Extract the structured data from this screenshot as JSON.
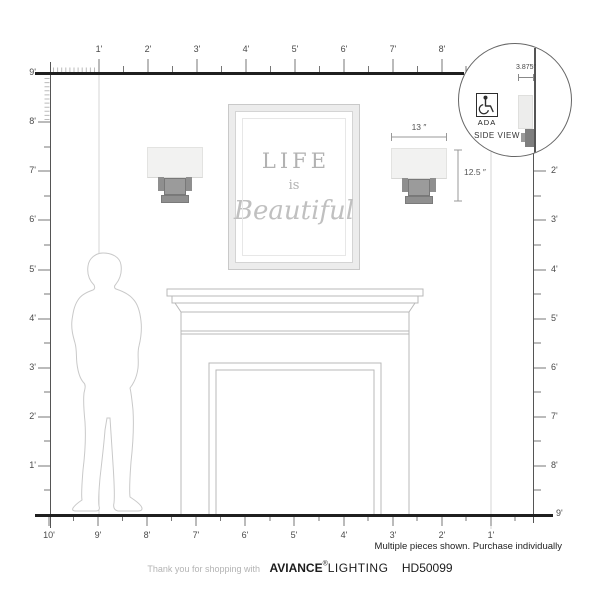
{
  "rulers": {
    "top": {
      "labels": [
        "1'",
        "2'",
        "3'",
        "4'",
        "5'",
        "6'",
        "7'",
        "8'"
      ],
      "corner_label": "9'"
    },
    "left": {
      "labels": [
        "8'",
        "7'",
        "6'",
        "5'",
        "4'",
        "3'",
        "2'",
        "1'"
      ]
    },
    "right": {
      "labels": [
        "2'",
        "3'",
        "4'",
        "5'",
        "6'",
        "7'",
        "8'"
      ],
      "corner_label": "9'"
    },
    "bottom": {
      "labels": [
        "10'",
        "9'",
        "8'",
        "7'",
        "6'",
        "5'",
        "4'",
        "3'",
        "2'",
        "1'"
      ]
    }
  },
  "artwork": {
    "line1": "LIFE",
    "line2": "is",
    "line3": "Beautiful"
  },
  "annotations": {
    "width": "13 ″",
    "height": "12.5 ″",
    "depth": "3.875″"
  },
  "inset": {
    "ada_label": "ADA",
    "side_view_label": "SIDE VIEW"
  },
  "notice": "Multiple pieces shown. Purchase individually",
  "footer": {
    "prefix": "Thank you for shopping with",
    "brand": "AVIANCE",
    "reg": "®",
    "brand2": "LIGHTING",
    "model": "HD50099"
  },
  "colors": {
    "ruler_line": "#1f1f1f",
    "tick": "#777777",
    "fine_tick": "#bbbbbb",
    "outline": "#b9b9b9",
    "silhouette": "#c9c9c9",
    "reference_line": "#d6d6d6",
    "shade": "#f2f2f1",
    "bracket": "#8f8f8f",
    "dimension": "#999999",
    "art_text": "#b2b2b2"
  }
}
